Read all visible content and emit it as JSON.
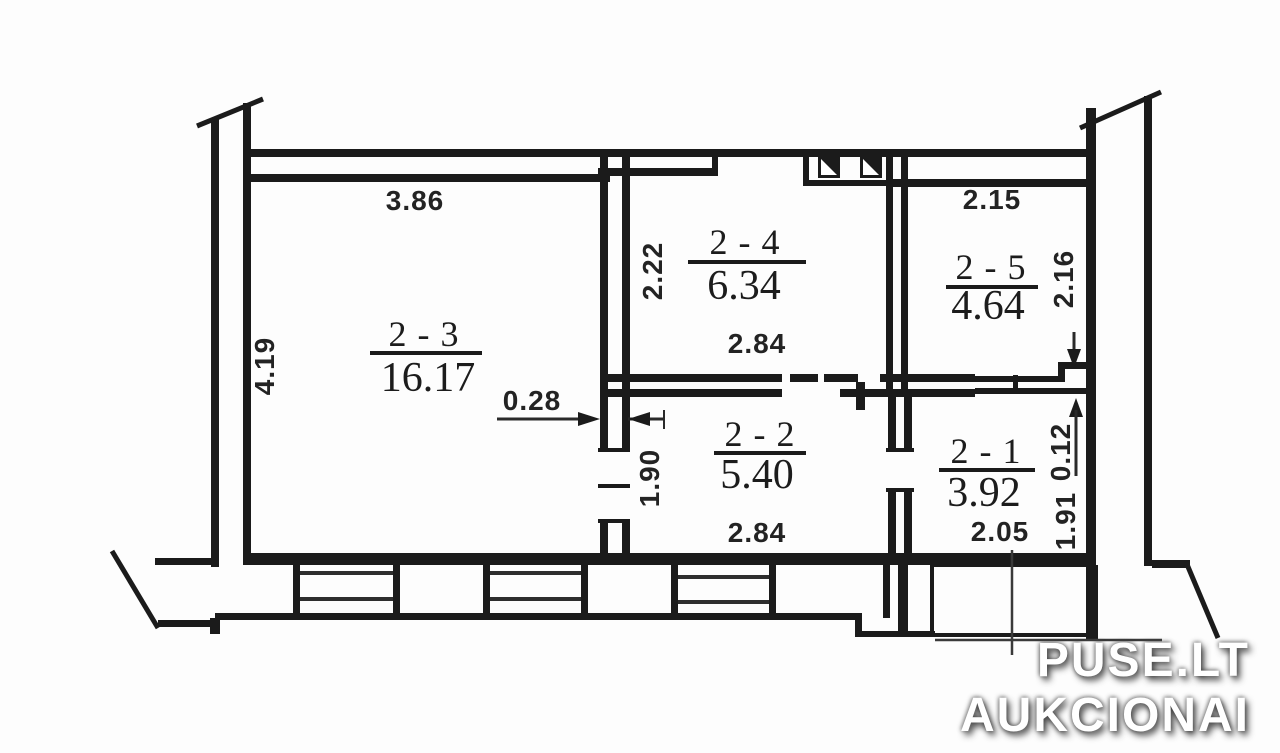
{
  "plan_title": "apartment-floor-plan",
  "watermark": {
    "line1": "PUSE.LT",
    "line2": "AUKCIONAI"
  },
  "rooms": [
    {
      "id": "2 - 3",
      "area": "16.17"
    },
    {
      "id": "2 - 4",
      "area": "6.34"
    },
    {
      "id": "2 - 5",
      "area": "4.64"
    },
    {
      "id": "2 - 2",
      "area": "5.40"
    },
    {
      "id": "2 - 1",
      "area": "3.92"
    }
  ],
  "dims": {
    "r23_width": "3.86",
    "r23_height": "4.19",
    "r24_height": "2.22",
    "r24_width": "2.84",
    "r25_width": "2.15",
    "r25_height": "2.16",
    "r22_height": "1.90",
    "r22_width": "2.84",
    "r21_width": "2.05",
    "r21_height": "1.91",
    "wall_gap": "0.12",
    "wall_thickness": "0.28"
  },
  "colors": {
    "line": "#1b1b1b",
    "background": "#fdfdfd",
    "watermark_text": "#ffffff"
  }
}
